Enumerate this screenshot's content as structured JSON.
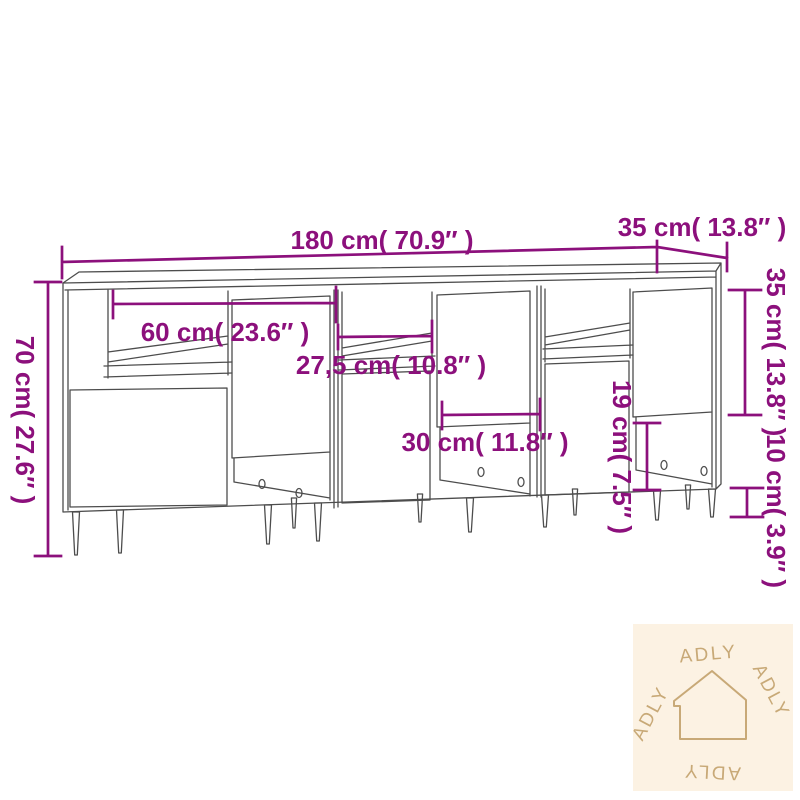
{
  "diagram": {
    "type": "furniture-dimension-diagram",
    "product": "three-sideboard-row-line-drawing",
    "dimensions": {
      "total_width": {
        "label": "180 cm( 70.9″ )"
      },
      "depth": {
        "label": "35 cm( 13.8″ )"
      },
      "total_height": {
        "label": "70 cm( 27.6″ )"
      },
      "unit_width": {
        "label": "60 cm( 23.6″ )"
      },
      "niche_width": {
        "label": "27,5 cm( 10.8″ )"
      },
      "door_width": {
        "label": "30 cm( 11.8″ )"
      },
      "door_height": {
        "label": "35 cm( 13.8″ )"
      },
      "open_section_height": {
        "label": "19 cm( 7.5″ )"
      },
      "leg_height": {
        "label": "10 cm( 3.9″ )"
      }
    },
    "watermark": {
      "brand": "ADLY",
      "icon": "house-outline",
      "brand_repeat": 4
    }
  },
  "colors": {
    "dimension_annotation": "#8c107c",
    "drawing_line": "#4d4d4d",
    "watermark_background": "#fcf2e3",
    "watermark_foreground": "#c8a977",
    "page_background": "#ffffff"
  }
}
